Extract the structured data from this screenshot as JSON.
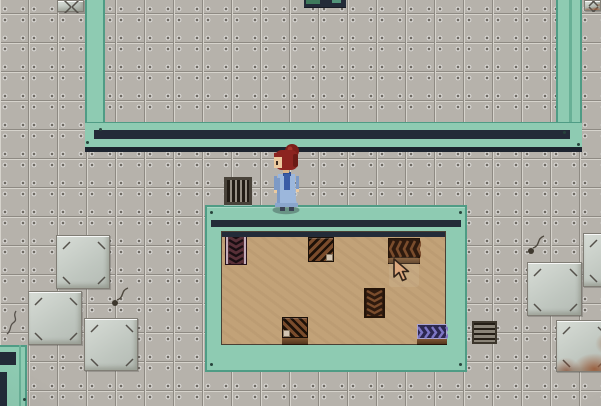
{
  "scene_title": "Top-down pixel sci-fi interior with red-haired character",
  "palette": {
    "tile_base": "#b6b2ab",
    "tile_line_dark": "#8e8a83",
    "tile_line_light": "#d6d3cc",
    "tile_rivet": "#6e6a63",
    "plate_face": "#d7dcd6",
    "plate_face2": "#bfc6bf",
    "plate_edge": "#807d75",
    "rust": "#9a5a38",
    "wall_teal": "#8ecbb2",
    "wall_teal_dark": "#4f9c85",
    "wall_teal_mid": "#68b096",
    "wall_navy": "#232b38",
    "wall_navy_dark": "#1d242f",
    "room_floor_tan": "#c2a278",
    "mat_dark": "#2e1a0e",
    "mat_chevron": "#7a4c2c",
    "mat_frame": "#241409",
    "mat_corner_face": "#40291a",
    "mat_maroon": "#583038",
    "mat_rail_light": "#c2adbb",
    "mat_purple_bg": "#2c2750",
    "mat_purple_chevron": "#7d76c4",
    "mat_purple_edge": "#a9a2cf",
    "base_brown_hi": "#7d5532",
    "base_brown_lo": "#55381e",
    "char_hair": "#8c2420",
    "char_hair_dark": "#6b1a15",
    "char_hair_highlight": "#a5352a",
    "char_skin": "#ecca9f",
    "char_coat": "#9cb7dc",
    "char_coat_dark": "#7d9ac6",
    "char_scarf": "#3a5ca6",
    "char_shoes": "#3a4254",
    "cursor_fill": "#dda87e",
    "cursor_outline": "#33241a"
  },
  "scene": {
    "viewport": {
      "width": 601,
      "height": 406
    },
    "upper_room": {
      "left_wall": {
        "x": 85,
        "y": 0,
        "w": 20,
        "h": 122
      },
      "right_wall": {
        "x": 556,
        "y": 0,
        "w": 26,
        "h": 122
      },
      "bottom_band": {
        "x": 85,
        "y": 122,
        "w": 497,
        "h": 25
      },
      "bottom_stripe1": {
        "x": 94,
        "y": 130,
        "w": 476,
        "h": 9
      },
      "bottom_stripe2": {
        "x": 85,
        "y": 147,
        "w": 497,
        "h": 5
      },
      "right_wall_midline": {
        "x": 569,
        "y": 0,
        "w": 3,
        "h": 122
      }
    },
    "lower_room": {
      "frame": {
        "x": 205,
        "y": 205,
        "w": 262,
        "h": 167
      },
      "top_stripe": {
        "x": 211,
        "y": 220,
        "w": 250,
        "h": 7
      },
      "floor": {
        "x": 222,
        "y": 232,
        "w": 223,
        "h": 112
      },
      "floor_shadow": {
        "x": 222,
        "y": 232,
        "w": 223,
        "h": 5
      }
    },
    "bottom_left_structure": {
      "block": {
        "x": 0,
        "y": 345,
        "w": 27,
        "h": 61
      },
      "navy_rect": {
        "x": 0,
        "y": 352,
        "w": 16,
        "h": 13
      },
      "navy_strip": {
        "x": 0,
        "y": 372,
        "w": 7,
        "h": 34
      },
      "midline": {
        "x": 19,
        "y": 345,
        "w": 2,
        "h": 61
      }
    },
    "top_object": {
      "x": 304,
      "y": 0,
      "w": 42,
      "h": 8
    },
    "plates": [
      {
        "x": 56,
        "y": 235,
        "w": 54,
        "h": 54
      },
      {
        "x": 28,
        "y": 291,
        "w": 54,
        "h": 54
      },
      {
        "x": 84,
        "y": 318,
        "w": 54,
        "h": 53
      },
      {
        "x": 527,
        "y": 262,
        "w": 55,
        "h": 54
      },
      {
        "x": 583,
        "y": 233,
        "w": 54,
        "h": 54
      },
      {
        "x": 556,
        "y": 320,
        "w": 54,
        "h": 52,
        "rust": true
      },
      {
        "x": 57,
        "y": 0,
        "w": 27,
        "h": 12
      },
      {
        "x": 584,
        "y": 0,
        "w": 17,
        "h": 11,
        "rust": true
      }
    ],
    "grates": [
      {
        "x": 224,
        "y": 177,
        "w": 28,
        "h": 28,
        "dir": "v"
      },
      {
        "x": 472,
        "y": 321,
        "w": 25,
        "h": 23,
        "dir": "h"
      }
    ],
    "mats": [
      {
        "type": "rail-vertical",
        "x": 226,
        "y": 233,
        "w": 20,
        "h": 31
      },
      {
        "type": "corner",
        "x": 308,
        "y": 237,
        "w": 26,
        "h": 25,
        "notch": "br",
        "angle": 135
      },
      {
        "type": "belt-horizontal",
        "x": 388,
        "y": 238,
        "w": 32,
        "h": 20,
        "base": 6
      },
      {
        "type": "belt-vertical",
        "x": 364,
        "y": 288,
        "w": 21,
        "h": 30
      },
      {
        "type": "corner",
        "x": 282,
        "y": 317,
        "w": 26,
        "h": 21,
        "notch": "bl",
        "angle": 45,
        "base": 7
      },
      {
        "type": "belt-purple",
        "x": 417,
        "y": 324,
        "w": 30,
        "h": 15,
        "base": 6
      }
    ],
    "wall_dots": [
      {
        "x": 99,
        "y": 128
      },
      {
        "x": 86,
        "y": 141
      },
      {
        "x": 563,
        "y": 131
      },
      {
        "x": 577,
        "y": 143
      },
      {
        "x": 210,
        "y": 211
      },
      {
        "x": 459,
        "y": 211
      },
      {
        "x": 210,
        "y": 363
      },
      {
        "x": 459,
        "y": 363
      },
      {
        "x": 23,
        "y": 398
      }
    ],
    "cracks": [
      {
        "type": "crack",
        "x": 4,
        "y": 310
      },
      {
        "type": "wire",
        "x": 106,
        "y": 286
      },
      {
        "type": "wire",
        "x": 522,
        "y": 234
      }
    ],
    "character": {
      "id": "red-haired-girl",
      "x": 269,
      "y": 144
    },
    "cursor": {
      "x": 391,
      "y": 257
    },
    "cursor_highlight": {
      "x": 389,
      "y": 257,
      "w": 30,
      "h": 30
    }
  }
}
